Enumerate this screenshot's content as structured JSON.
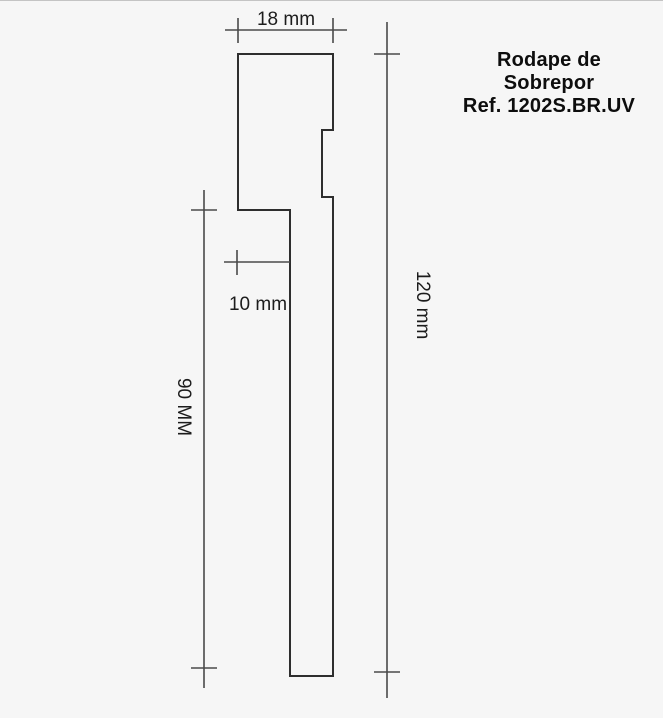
{
  "title": {
    "lines": [
      "Rodape de",
      "Sobrepor",
      "Ref. 1202S.BR.UV"
    ]
  },
  "dimensions": {
    "top_width": {
      "label": "18 mm"
    },
    "step_offset": {
      "label": "10 mm"
    },
    "strip_height": {
      "label": "90 MM"
    },
    "total_height": {
      "label": "120 mm"
    }
  },
  "colors": {
    "background": "#f6f6f6",
    "profile_line": "#2e2e2e",
    "dimension_line": "#4a4a4a",
    "text": "#1c1c1c"
  }
}
